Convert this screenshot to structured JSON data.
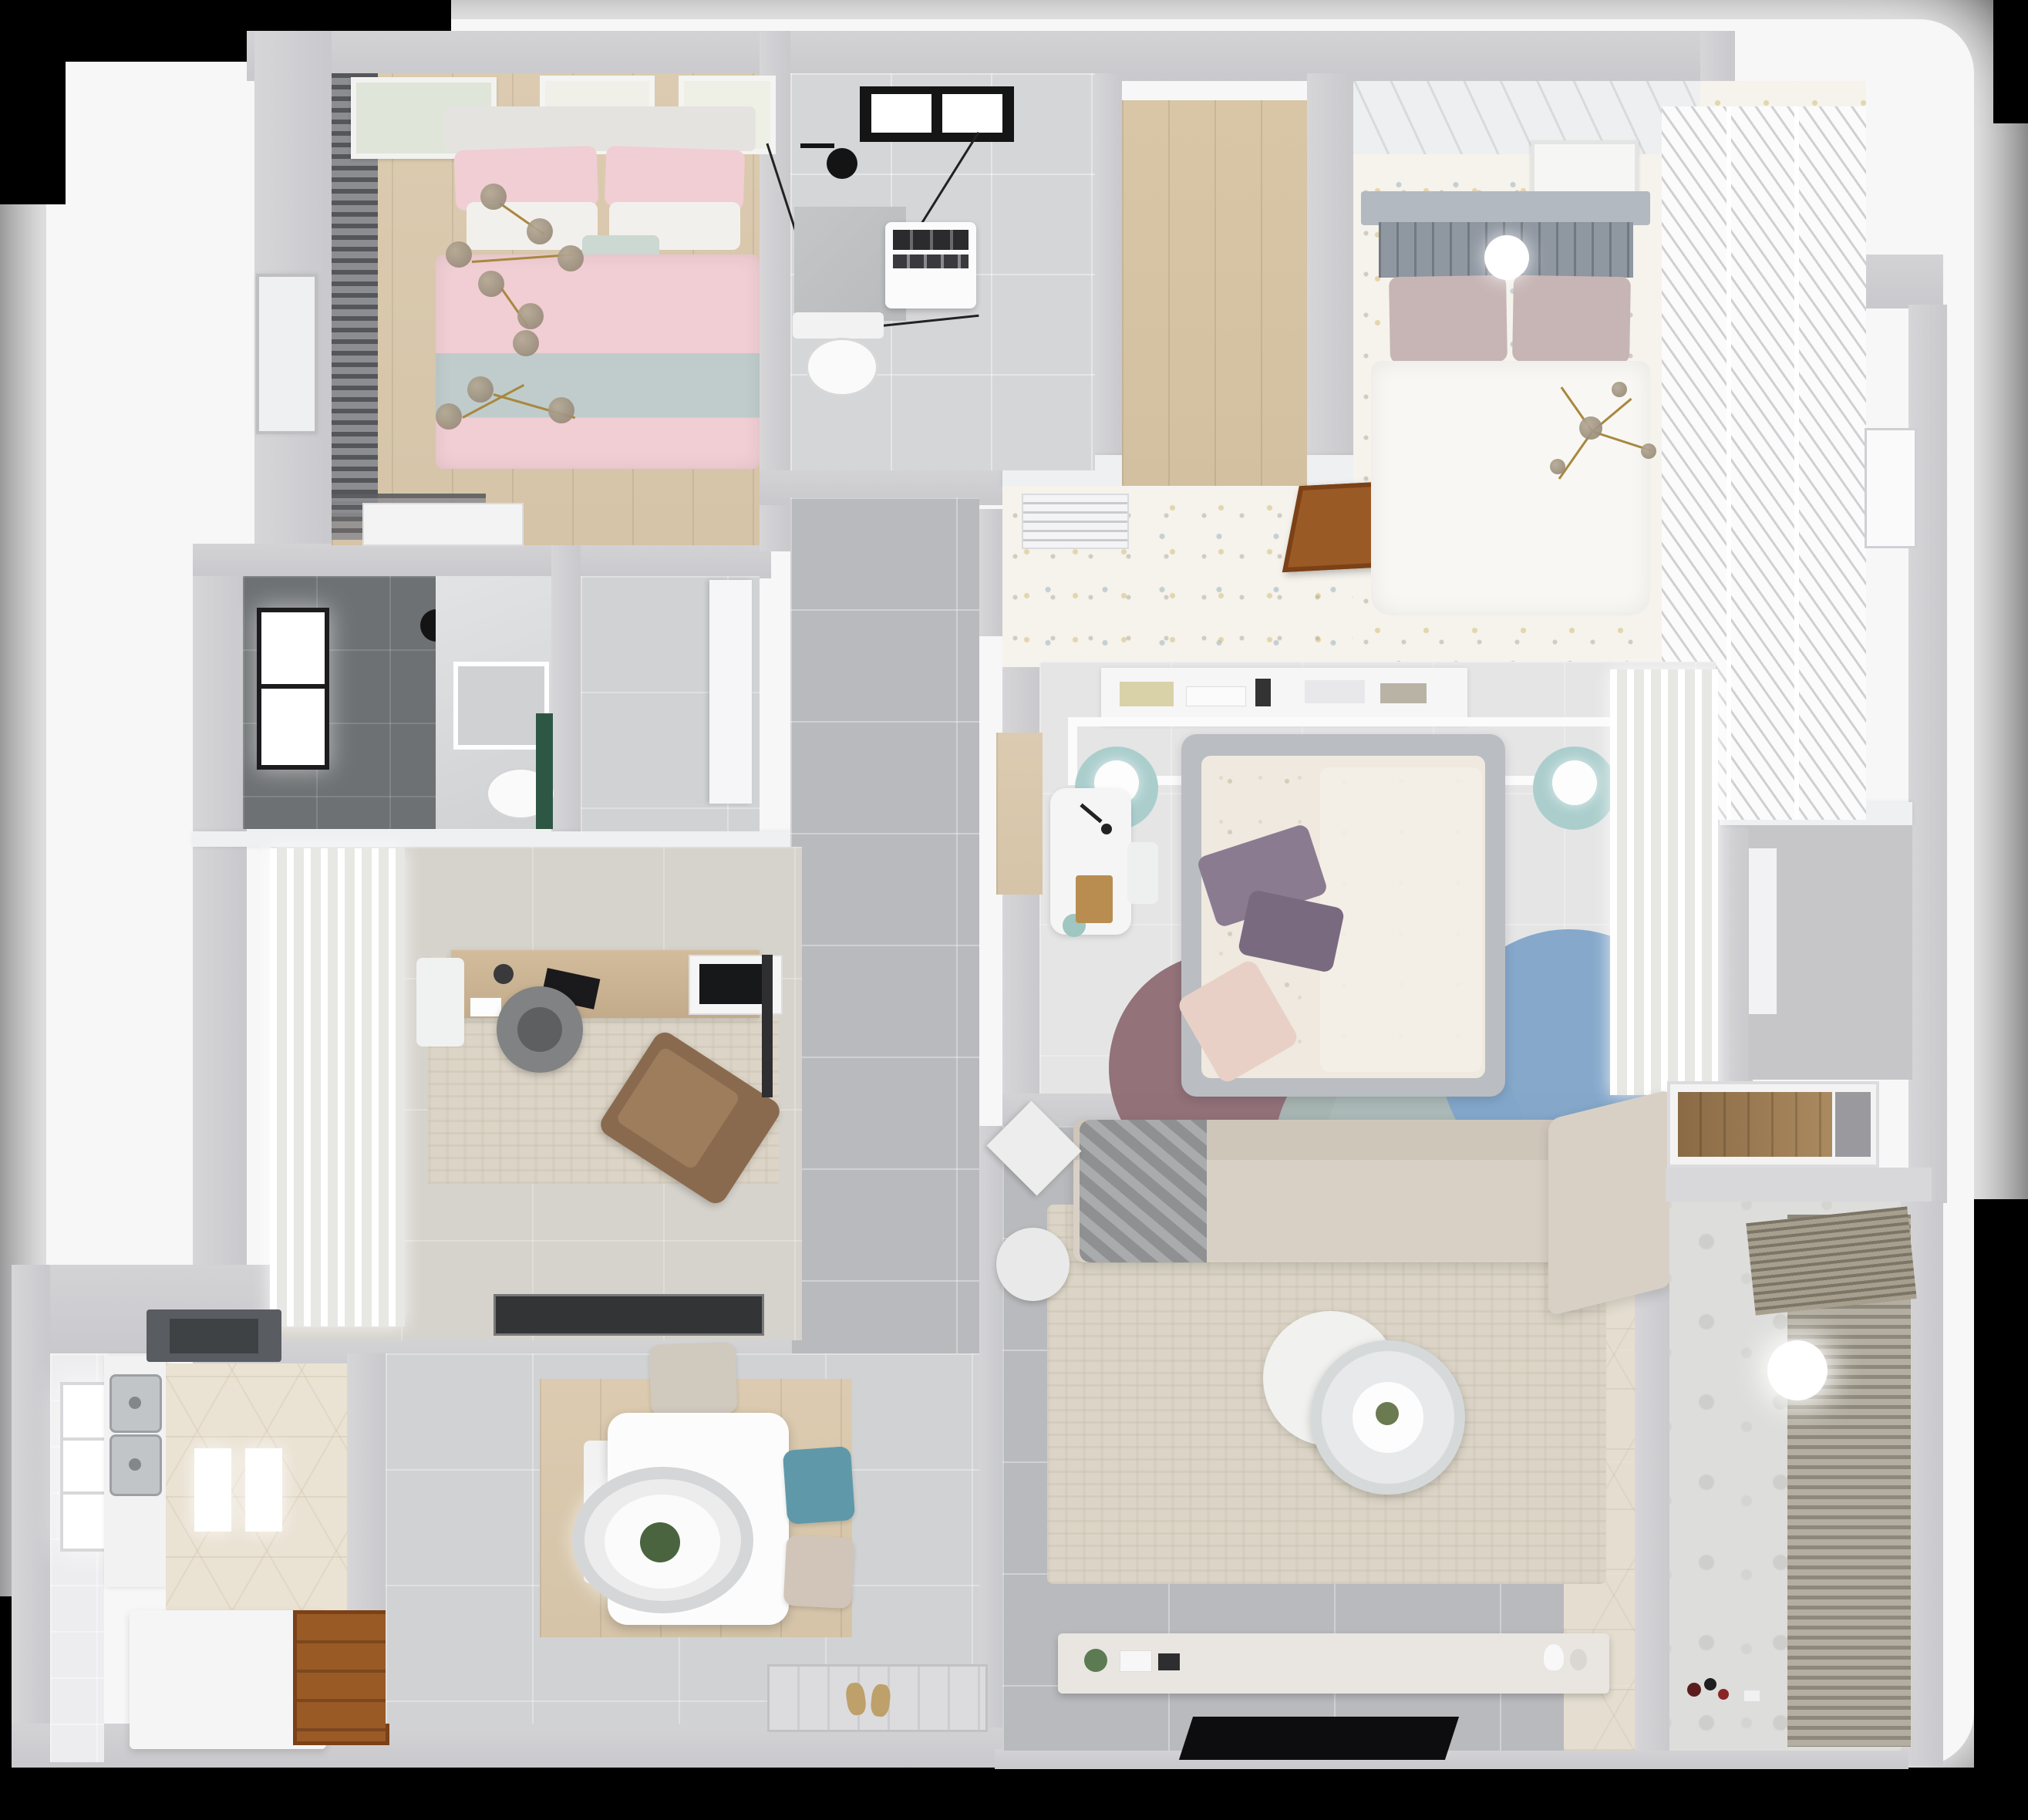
{
  "scene": {
    "type": "3d-floorplan-top-down-render",
    "description": "Photorealistic top-down dollhouse render of a multi-room apartment, no visible text or UI controls",
    "background": "#000000"
  },
  "palette": {
    "black-bg": "#000000",
    "backdrop": "#f7f7f8",
    "wall-outer": "#c9c9cd",
    "wall-inner": "#eff0f2",
    "tile-gray": "#b9babd",
    "tile-light": "#d5d6d8",
    "tile-mid": "#d1d2d4",
    "wood-light": "#d5c4a8",
    "wood-plank": "#d2c0a0",
    "wood-door": "#9a5a26",
    "speckle-base": "#f5f3ec",
    "pink-duvet": "#f0ced4",
    "blue-blanket": "#c0cccc",
    "teal-chair": "#5f99a9",
    "teal-pouf": "#abcecd",
    "blue-rug": "#7fa4c9",
    "mauve-rug": "#8e6c74",
    "gray-teal-rug": "#a8b7b5",
    "sofa-beige": "#d9d0c5",
    "rug-beige": "#dcd5c7",
    "dark-tile": "#6e7174",
    "green-accent": "#2e5645",
    "gold": "#a8883f",
    "smoke": "#8f8170",
    "black": "#0d0d0f",
    "white": "#fbfbfc",
    "hex-tile": "#eae2d3",
    "blinds-dark": "#55565a",
    "marble": "#b8babc",
    "mauve-pillow": "#c7b5b5",
    "purple-pillow": "#8b7b90",
    "headboard-gray": "#8f97a1",
    "chair-brown": "#8a6a4e"
  },
  "rooms": [
    {
      "id": "bedroom-pink",
      "position": "top-left",
      "floor": "light wood",
      "furniture": [
        "double-bed-pink-bedding",
        "blue-gray-blanket-band",
        "gold-branch-chandelier",
        "dark-window-blinds",
        "three-wall-art-frames",
        "white-dresser",
        "side-door"
      ]
    },
    {
      "id": "bathroom-top",
      "position": "top-center",
      "floor": "light gray tile",
      "furniture": [
        "black-framed-skylight",
        "black-shower-fixture",
        "glass-shower-screen",
        "marble-shower-tray",
        "washing-machine",
        "toilet"
      ]
    },
    {
      "id": "closet-room",
      "position": "top-center-right",
      "floor": "wood plank",
      "furniture": []
    },
    {
      "id": "bedroom-master",
      "position": "top-right",
      "floor": "speckled confetti carpet",
      "furniture": [
        "gray-slat-headboard-bed",
        "mauve-pillows",
        "white-duvet",
        "sphere-lamp",
        "mini-chandelier",
        "louver-wardrobe",
        "paneled-wall-art",
        "ac-vent",
        "open-wood-door",
        "balcony-doorway"
      ]
    },
    {
      "id": "hallway",
      "position": "center",
      "floor": "large gray tile",
      "furniture": []
    },
    {
      "id": "bathroom-middle",
      "position": "middle-left",
      "floor": "dark tile + marble",
      "furniture": [
        "window",
        "black-shower-head",
        "shower-tray",
        "toilet",
        "green-cabinet"
      ]
    },
    {
      "id": "study",
      "position": "center-left",
      "floor": "beige tile",
      "furniture": [
        "white-curtain-wall",
        "distressed-rug",
        "wood-desk",
        "laptop",
        "monitor",
        "round-office-chair",
        "brown-lounge-chair",
        "dark-doormat"
      ]
    },
    {
      "id": "bedroom-middle",
      "position": "center-right",
      "floor": "white tile",
      "furniture": [
        "gray-frame-bed-floral-duvet",
        "purple-pillows",
        "blush-pillow",
        "headboard-shelf-books",
        "canopy-rail",
        "two-teal-poufs-with-lamps",
        "white-desk",
        "round-rug-mauve",
        "round-rug-gray-teal",
        "round-rug-blue",
        "sheer-wardrobe",
        "entry-wood-threshold"
      ]
    },
    {
      "id": "living-room",
      "position": "bottom-center-right",
      "floor": "gray tile + hex border",
      "furniture": [
        "l-shaped-beige-sofa",
        "gray-throw",
        "diamond-side-table",
        "round-ottoman",
        "beige-area-rug",
        "round-two-tier-coffee-table",
        "media-console",
        "flat-tv-panel",
        "decor-plant"
      ]
    },
    {
      "id": "kitchen",
      "position": "bottom-left",
      "floor": "patterned hex tile",
      "furniture": [
        "window",
        "double-stainless-sink",
        "counter",
        "range-hood",
        "ceiling-light-reflections",
        "white-island",
        "wood-door-threshold"
      ]
    },
    {
      "id": "dining",
      "position": "bottom-center-left",
      "floor": "wood under table",
      "furniture": [
        "white-dining-table",
        "oval-pendant-lamp-with-plant",
        "beige-chair",
        "teal-chair",
        "beige-chair-2",
        "white-bench"
      ]
    },
    {
      "id": "entry",
      "position": "bottom-center",
      "floor": "light gray tile",
      "furniture": [
        "patterned-doormat",
        "slippers"
      ]
    },
    {
      "id": "balcony",
      "position": "bottom-right",
      "floor": "motif tile",
      "furniture": [
        "hanging-blind-slats",
        "round-ceiling-light",
        "toys"
      ]
    },
    {
      "id": "utility-niche",
      "position": "right-middle",
      "floor": "gray",
      "furniture": [
        "wood-shelf-cabinet"
      ]
    }
  ]
}
